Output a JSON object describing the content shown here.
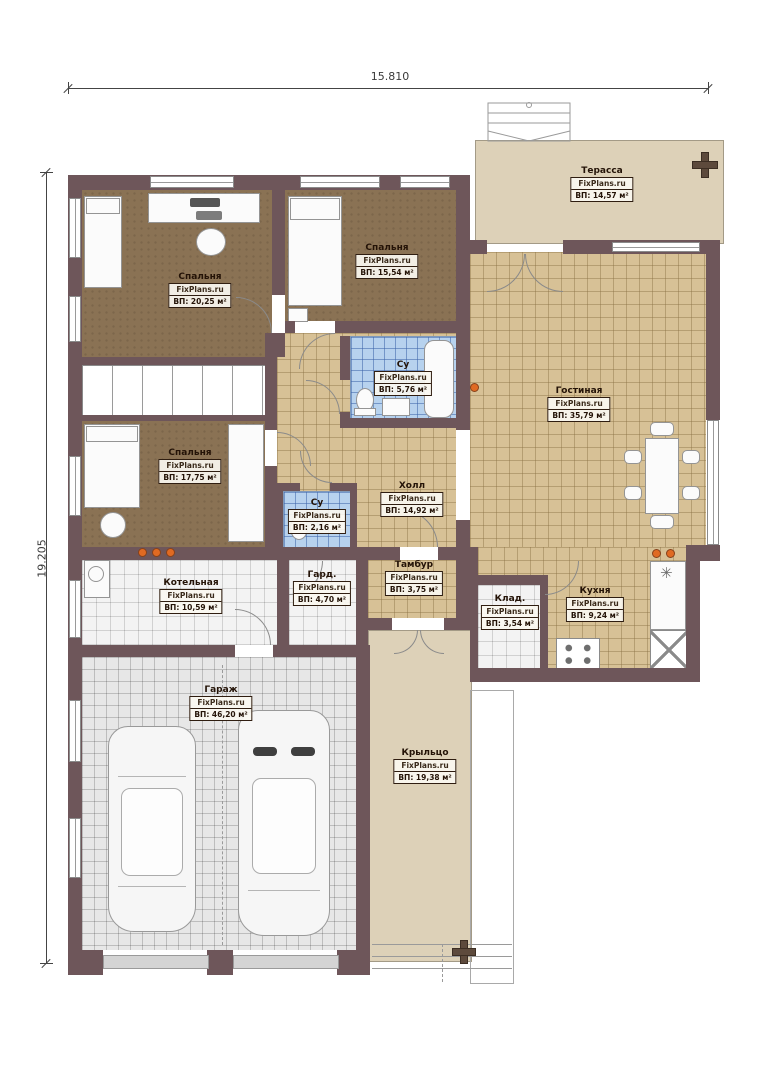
{
  "brand": "FixPlans.ru",
  "dimensions": {
    "top": "15.810",
    "left": "19.205"
  },
  "rooms": {
    "terrace": {
      "name": "Терасса",
      "area": "ВП: 14,57 м²"
    },
    "bedroom1": {
      "name": "Спальня",
      "area": "ВП: 20,25 м²"
    },
    "bedroom2": {
      "name": "Спальня",
      "area": "ВП: 15,54 м²"
    },
    "bathroom_main": {
      "name": "Су",
      "area": "ВП: 5,76 м²"
    },
    "bedroom3": {
      "name": "Спальня",
      "area": "ВП: 17,75 м²"
    },
    "bathroom_small": {
      "name": "Су",
      "area": "ВП: 2,16 м²"
    },
    "hall": {
      "name": "Холл",
      "area": "ВП: 14,92 м²"
    },
    "living": {
      "name": "Гостиная",
      "area": "ВП: 35,79 м²"
    },
    "boiler": {
      "name": "Котельная",
      "area": "ВП: 10,59 м²"
    },
    "wardrobe": {
      "name": "Гард.",
      "area": "ВП: 4,70 м²"
    },
    "tambour": {
      "name": "Тамбур",
      "area": "ВП: 3,75 м²"
    },
    "storage": {
      "name": "Клад.",
      "area": "ВП: 3,54 м²"
    },
    "kitchen": {
      "name": "Кухня",
      "area": "ВП: 9,24 м²"
    },
    "garage": {
      "name": "Гараж",
      "area": "ВП: 46,20 м²"
    },
    "porch": {
      "name": "Крыльцо",
      "area": "ВП: 19,38 м²"
    }
  },
  "colors": {
    "wall": "#6e565a",
    "floor_tan": "#d7c196",
    "floor_blue": "#b7d2ee",
    "floor_brown": "#8a7254",
    "floor_beige": "#ddd1b8",
    "vent": "#e06a22"
  }
}
